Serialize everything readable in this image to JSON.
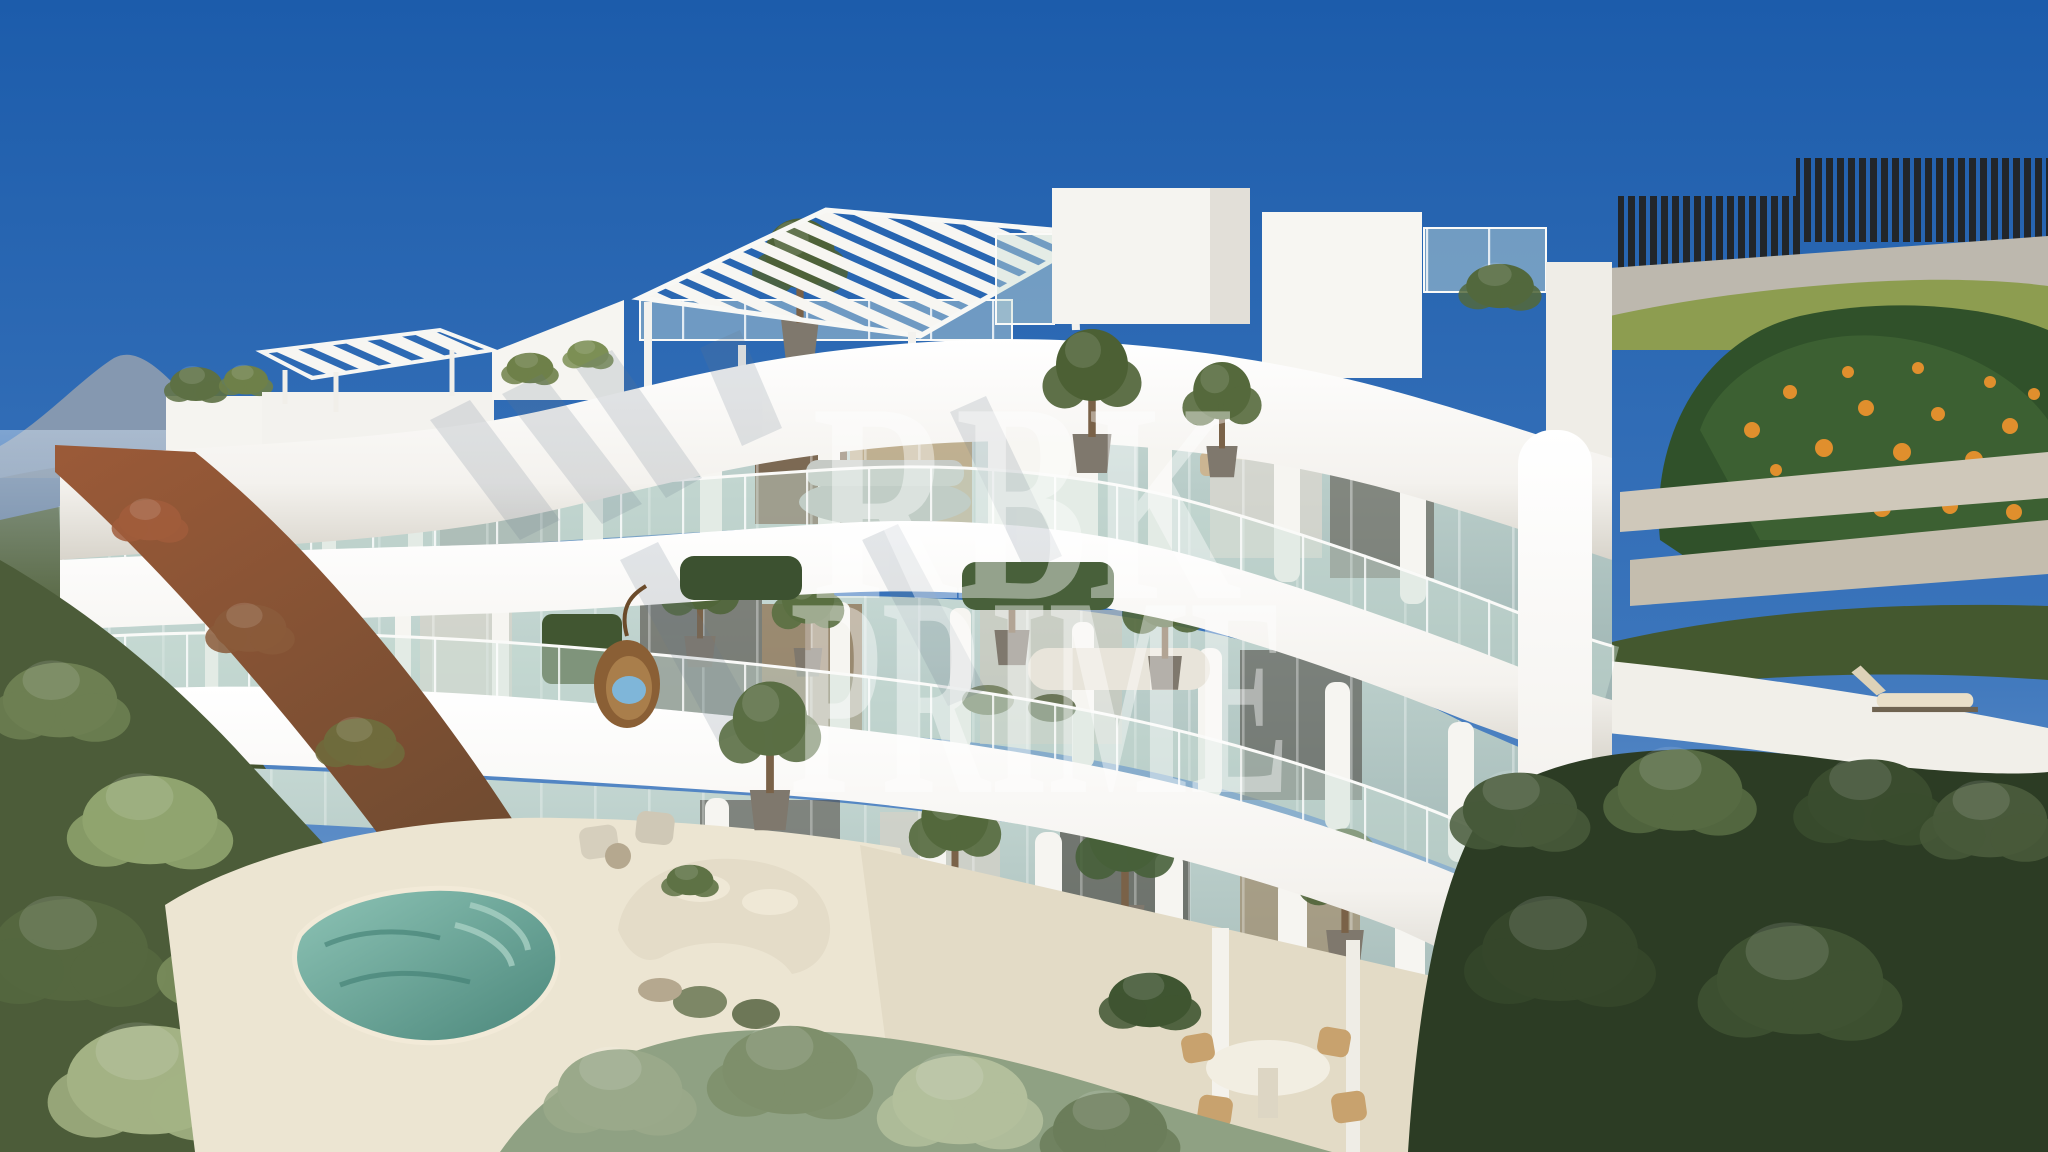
{
  "meta": {
    "type": "architectural-render",
    "alt": "Aerial 3D render of a modern white luxury apartment building with organically curved balcony bands, glass balustrades, rooftop pergolas, potted olive trees, a small teal plunge pool, landscaped gardens, an orange tree and a dark slatted fence under a clear blue sky",
    "watermark_brand": "RBK PRIME"
  },
  "watermark": {
    "line1": "RBK",
    "line2": "PRIME",
    "color": "#ffffff",
    "opacity": "0.42"
  },
  "palette": {
    "sky_top": "#1c5cab",
    "sky_mid": "#3a74bb",
    "sky_horizon": "#8db0d8",
    "building_white": "#f8f7f3",
    "building_shade": "#d9d5cc",
    "soffit_shadow": "#b7b0a3",
    "glass_light": "#c4d7d2",
    "glass_deep": "#9db3b2",
    "rail_glass": "#cbe0d8",
    "interior_wood": "#6b4f35",
    "interior_warm": "#c0a277",
    "interior_dark": "#55514a",
    "pool_light": "#8ec4b6",
    "pool_deep": "#4b877b",
    "terrace_cream": "#ece5d2",
    "hedge_dark": "#2c3c24",
    "hedge_green": "#5c7041",
    "hedge_sage": "#9aa98a",
    "ivy_red": "#9b5a38",
    "ivy_shadow": "#6d4a30",
    "mountain_far": "#8a9bb0",
    "mountain_near": "#7b8a9b",
    "hills_green": "#55653f",
    "fence_dark": "#22262a",
    "stone_wall": "#bdb8ae",
    "bright_hedge": "#8d9d50",
    "orange_foliage": "#30512a",
    "orange_fruit": "#e08f2d",
    "wicker_tan": "#c8a26e",
    "cushion_blue": "#7fb6d9",
    "egg_chair": "#8a5f35"
  },
  "scene": {
    "subject": "Curved white luxury apartment building, three balcony levels plus roof terraces",
    "elements": [
      "clear blue sky gradient",
      "distant hazy mountain and green hills on the left",
      "two white slatted rooftop pergolas",
      "glass balustrades along every wavy balcony band",
      "potted olive trees and hedge planters on balconies",
      "hanging rattan egg chair with light blue cushion",
      "outdoor lounge sofas, armchairs, loungers and round dining table",
      "teal plunge pool on cream stone terrace",
      "red-rust ivy retaining wall bottom left",
      "sage and dark green hedges in the foreground",
      "dark vertical-slat fence on a stone wall top right",
      "orange tree full of fruit on the right"
    ]
  }
}
